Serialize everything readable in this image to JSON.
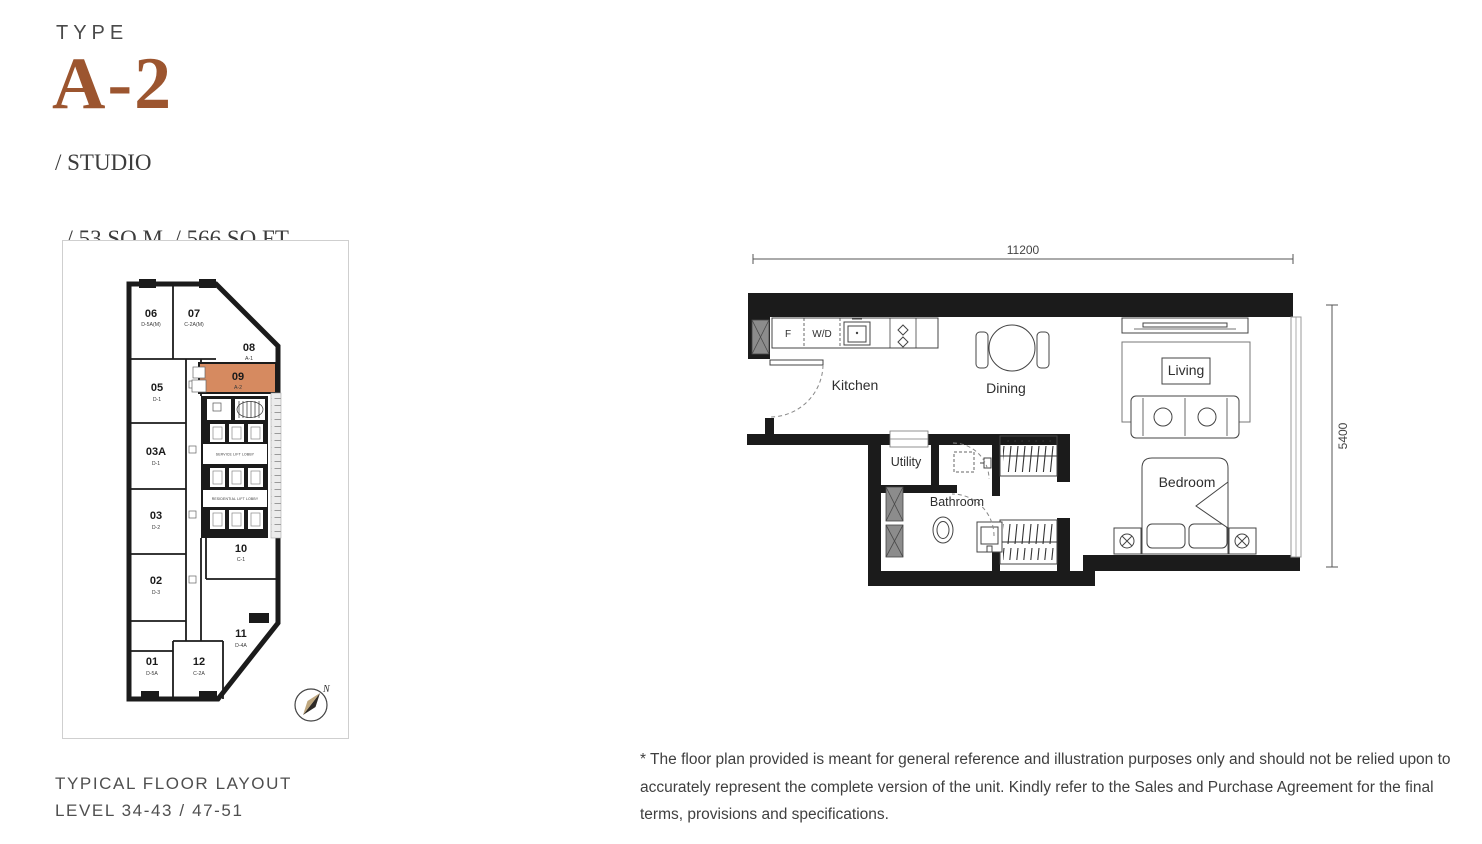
{
  "header": {
    "type_label": "TYPE",
    "unit_code": "A-2",
    "spec_lines": [
      "/ STUDIO",
      "/ 53 SQ.M. / 566 SQ.FT."
    ]
  },
  "key_plan": {
    "units": [
      {
        "no": "06",
        "type": "D-5A(M)"
      },
      {
        "no": "07",
        "type": "C-2A(M)"
      },
      {
        "no": "08",
        "type": "A-1"
      },
      {
        "no": "05",
        "type": "D-1"
      },
      {
        "no": "09",
        "type": "A-2",
        "highlighted": true
      },
      {
        "no": "03A",
        "type": "D-1"
      },
      {
        "no": "03",
        "type": "D-2"
      },
      {
        "no": "02",
        "type": "D-3"
      },
      {
        "no": "10",
        "type": "C-1"
      },
      {
        "no": "11",
        "type": "D-4A"
      },
      {
        "no": "01",
        "type": "D-5A"
      },
      {
        "no": "12",
        "type": "C-2A"
      }
    ],
    "service_lobby": "SERVICE LIFT LOBBY",
    "residential_lobby": "RESIDENTIAL LIFT LOBBY",
    "compass_label": "N"
  },
  "floor_plan": {
    "dim_width": "11200",
    "dim_depth": "5400",
    "rooms": {
      "kitchen": "Kitchen",
      "dining": "Dining",
      "living": "Living",
      "bedroom": "Bedroom",
      "utility": "Utility",
      "bathroom": "Bathroom"
    },
    "appliances": {
      "fridge": "F",
      "washer_dryer": "W/D"
    }
  },
  "footer": {
    "line1": "TYPICAL FLOOR LAYOUT",
    "line2": "LEVEL 34-43 / 47-51"
  },
  "disclaimer": "* The floor plan provided is meant for general reference and illustration purposes only and should not be relied upon to accurately represent the complete version of the unit. Kindly refer to the Sales and Purchase Agreement for the final terms, provisions and specifications.",
  "colors": {
    "accent": "#9C552F",
    "highlight": "#D68A60",
    "wall": "#1B1B1B"
  }
}
